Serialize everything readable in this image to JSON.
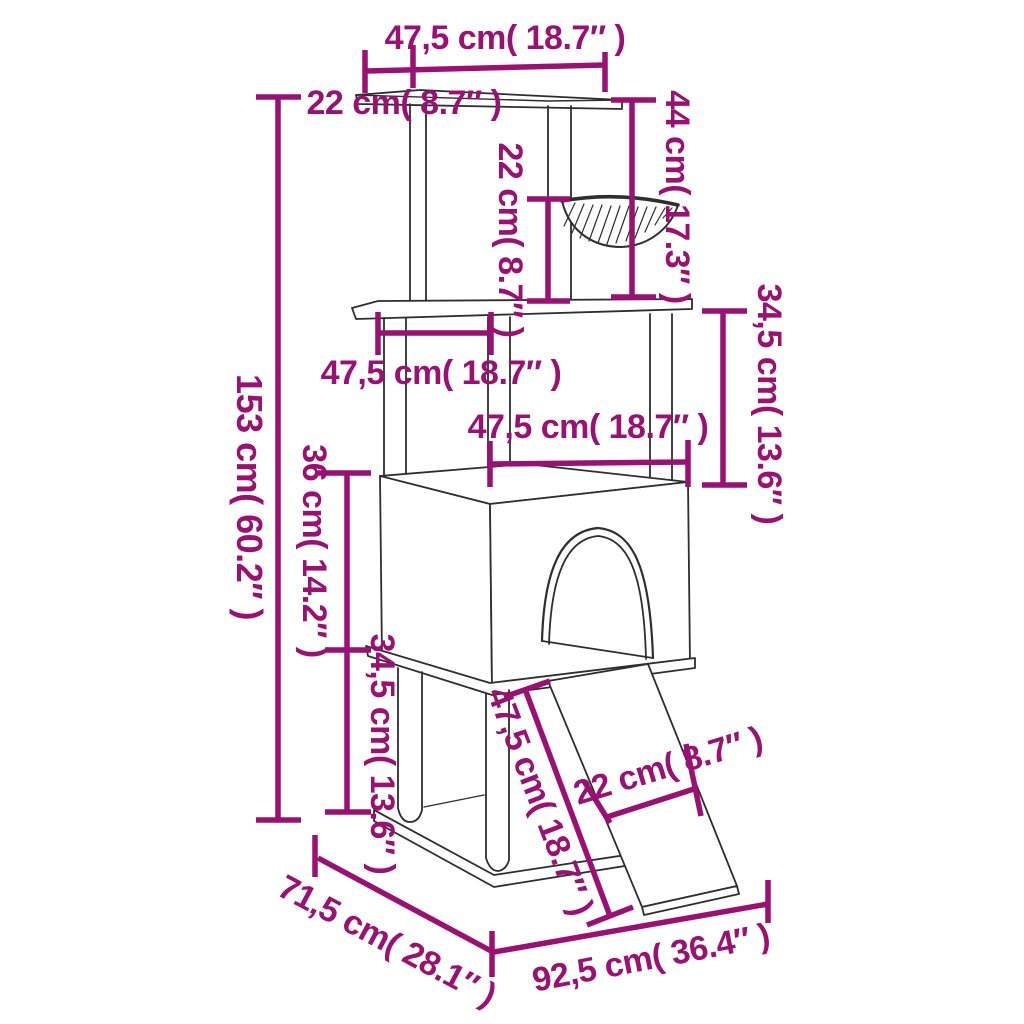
{
  "page": {
    "width": 1024,
    "height": 1024,
    "background": "#ffffff"
  },
  "colors": {
    "dimension_accent": "#9A1173",
    "line_art": "#2e2e2e"
  },
  "diagram": {
    "subject": "cat-tree-with-scratching-posts-dimension-diagram",
    "units": [
      "cm",
      "inch"
    ]
  },
  "annotations": {
    "top_width": {
      "text": "47,5 cm( 18.7″ )",
      "cm": "47,5",
      "inch": "18.7"
    },
    "top_left_offset": {
      "text": "22 cm( 8.7″ )",
      "cm": "22",
      "inch": "8.7"
    },
    "hammock_clearance": {
      "text": "22 cm( 8.7″ )",
      "cm": "22",
      "inch": "8.7"
    },
    "hammock_drop": {
      "text": "44 cm( 17.3″ )",
      "cm": "44",
      "inch": "17.3"
    },
    "upper_right_gap": {
      "text": "34,5 cm( 13.6″ )",
      "cm": "34,5",
      "inch": "13.6"
    },
    "platform_depth": {
      "text": "47,5 cm( 18.7″ )",
      "cm": "47,5",
      "inch": "18.7"
    },
    "house_width": {
      "text": "47,5 cm( 18.7″ )",
      "cm": "47,5",
      "inch": "18.7"
    },
    "total_height": {
      "text": "153 cm( 60.2″ )",
      "cm": "153",
      "inch": "60.2"
    },
    "house_height": {
      "text": "36 cm( 14.2″ )",
      "cm": "36",
      "inch": "14.2"
    },
    "lower_left_gap": {
      "text": "34,5 cm( 13.6″ )",
      "cm": "34,5",
      "inch": "13.6"
    },
    "ramp_length": {
      "text": "47,5 cm( 18.7″ )",
      "cm": "47,5",
      "inch": "18.7"
    },
    "ramp_width": {
      "text": "22 cm( 8.7″ )",
      "cm": "22",
      "inch": "8.7"
    },
    "base_depth": {
      "text": "71,5 cm( 28.1″ )",
      "cm": "71,5",
      "inch": "28.1"
    },
    "base_width": {
      "text": "92,5 cm( 36.4″ )",
      "cm": "92,5",
      "inch": "36.4"
    }
  }
}
